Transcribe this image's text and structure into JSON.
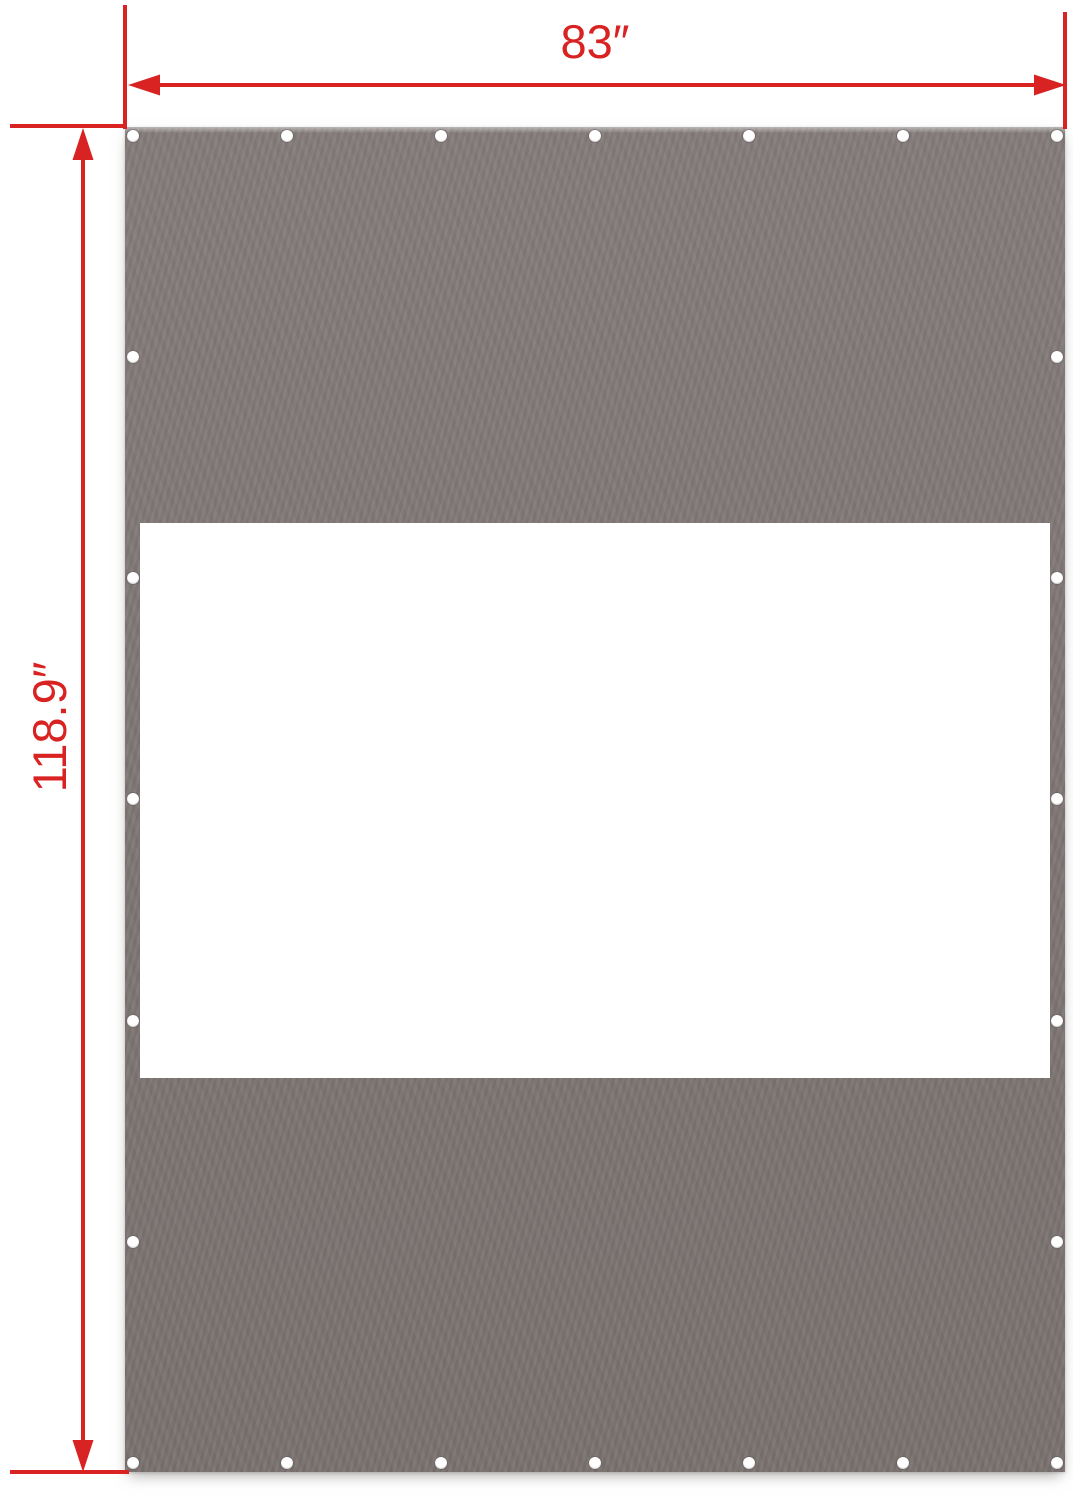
{
  "dimensions": {
    "width_label": "83″",
    "height_label": "118.9″"
  },
  "colors": {
    "annotation_red": "#d92222",
    "panel_gray": "#7f7775",
    "panel_gray_light": "#847c7a",
    "panel_gray_dark": "#7a726f",
    "window_white": "#ffffff",
    "grommet_white": "#ffffff",
    "background": "#ffffff"
  },
  "panel": {
    "description": "gray tarp panel with white window and edge grommets",
    "grommet_count_top": 7,
    "grommet_count_bottom": 7,
    "grommet_count_left": 7,
    "grommet_count_right": 7
  }
}
